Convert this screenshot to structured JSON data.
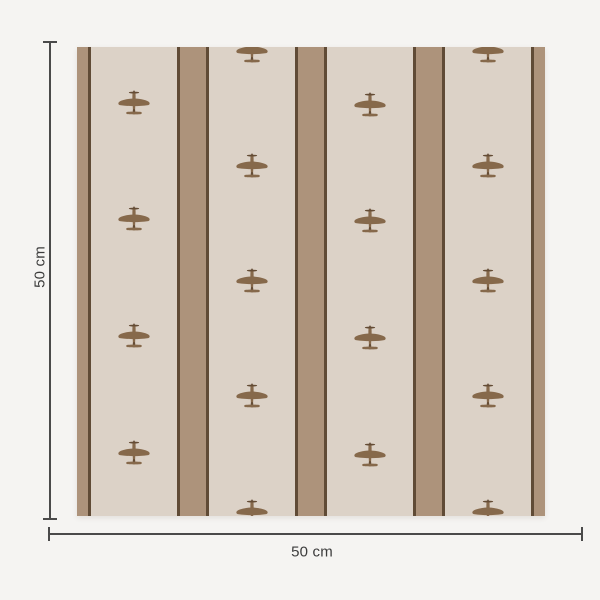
{
  "page": {
    "background": "#f5f4f2"
  },
  "dimensions": {
    "height_label": "50 cm",
    "width_label": "50 cm",
    "line_color": "#4a4a4a",
    "text_color": "#3c3c3c"
  },
  "swatch": {
    "x": 77,
    "y": 47,
    "width": 468,
    "height": 469,
    "colors": {
      "beige": "#dcd2c7",
      "tan": "#ad937b",
      "dark": "#604b36",
      "plane": "#86694b",
      "plane_dark": "#644c35"
    },
    "stripes": [
      {
        "color": "tan",
        "width": 11
      },
      {
        "color": "dark",
        "width": 3
      },
      {
        "color": "beige",
        "width": 86
      },
      {
        "color": "dark",
        "width": 3
      },
      {
        "color": "tan",
        "width": 26
      },
      {
        "color": "dark",
        "width": 3
      },
      {
        "color": "beige",
        "width": 86
      },
      {
        "color": "dark",
        "width": 3
      },
      {
        "color": "tan",
        "width": 26
      },
      {
        "color": "dark",
        "width": 3
      },
      {
        "color": "beige",
        "width": 86
      },
      {
        "color": "dark",
        "width": 3
      },
      {
        "color": "tan",
        "width": 26
      },
      {
        "color": "dark",
        "width": 3
      },
      {
        "color": "beige",
        "width": 86
      },
      {
        "color": "dark",
        "width": 3
      },
      {
        "color": "tan",
        "width": 11
      }
    ],
    "plane_columns": [
      {
        "x": 57,
        "ys": [
          56,
          172,
          289,
          406
        ]
      },
      {
        "x": 175,
        "ys": [
          4,
          119,
          234,
          349,
          465
        ]
      },
      {
        "x": 293,
        "ys": [
          58,
          174,
          291,
          408
        ]
      },
      {
        "x": 411,
        "ys": [
          4,
          119,
          234,
          349,
          465
        ]
      }
    ]
  }
}
